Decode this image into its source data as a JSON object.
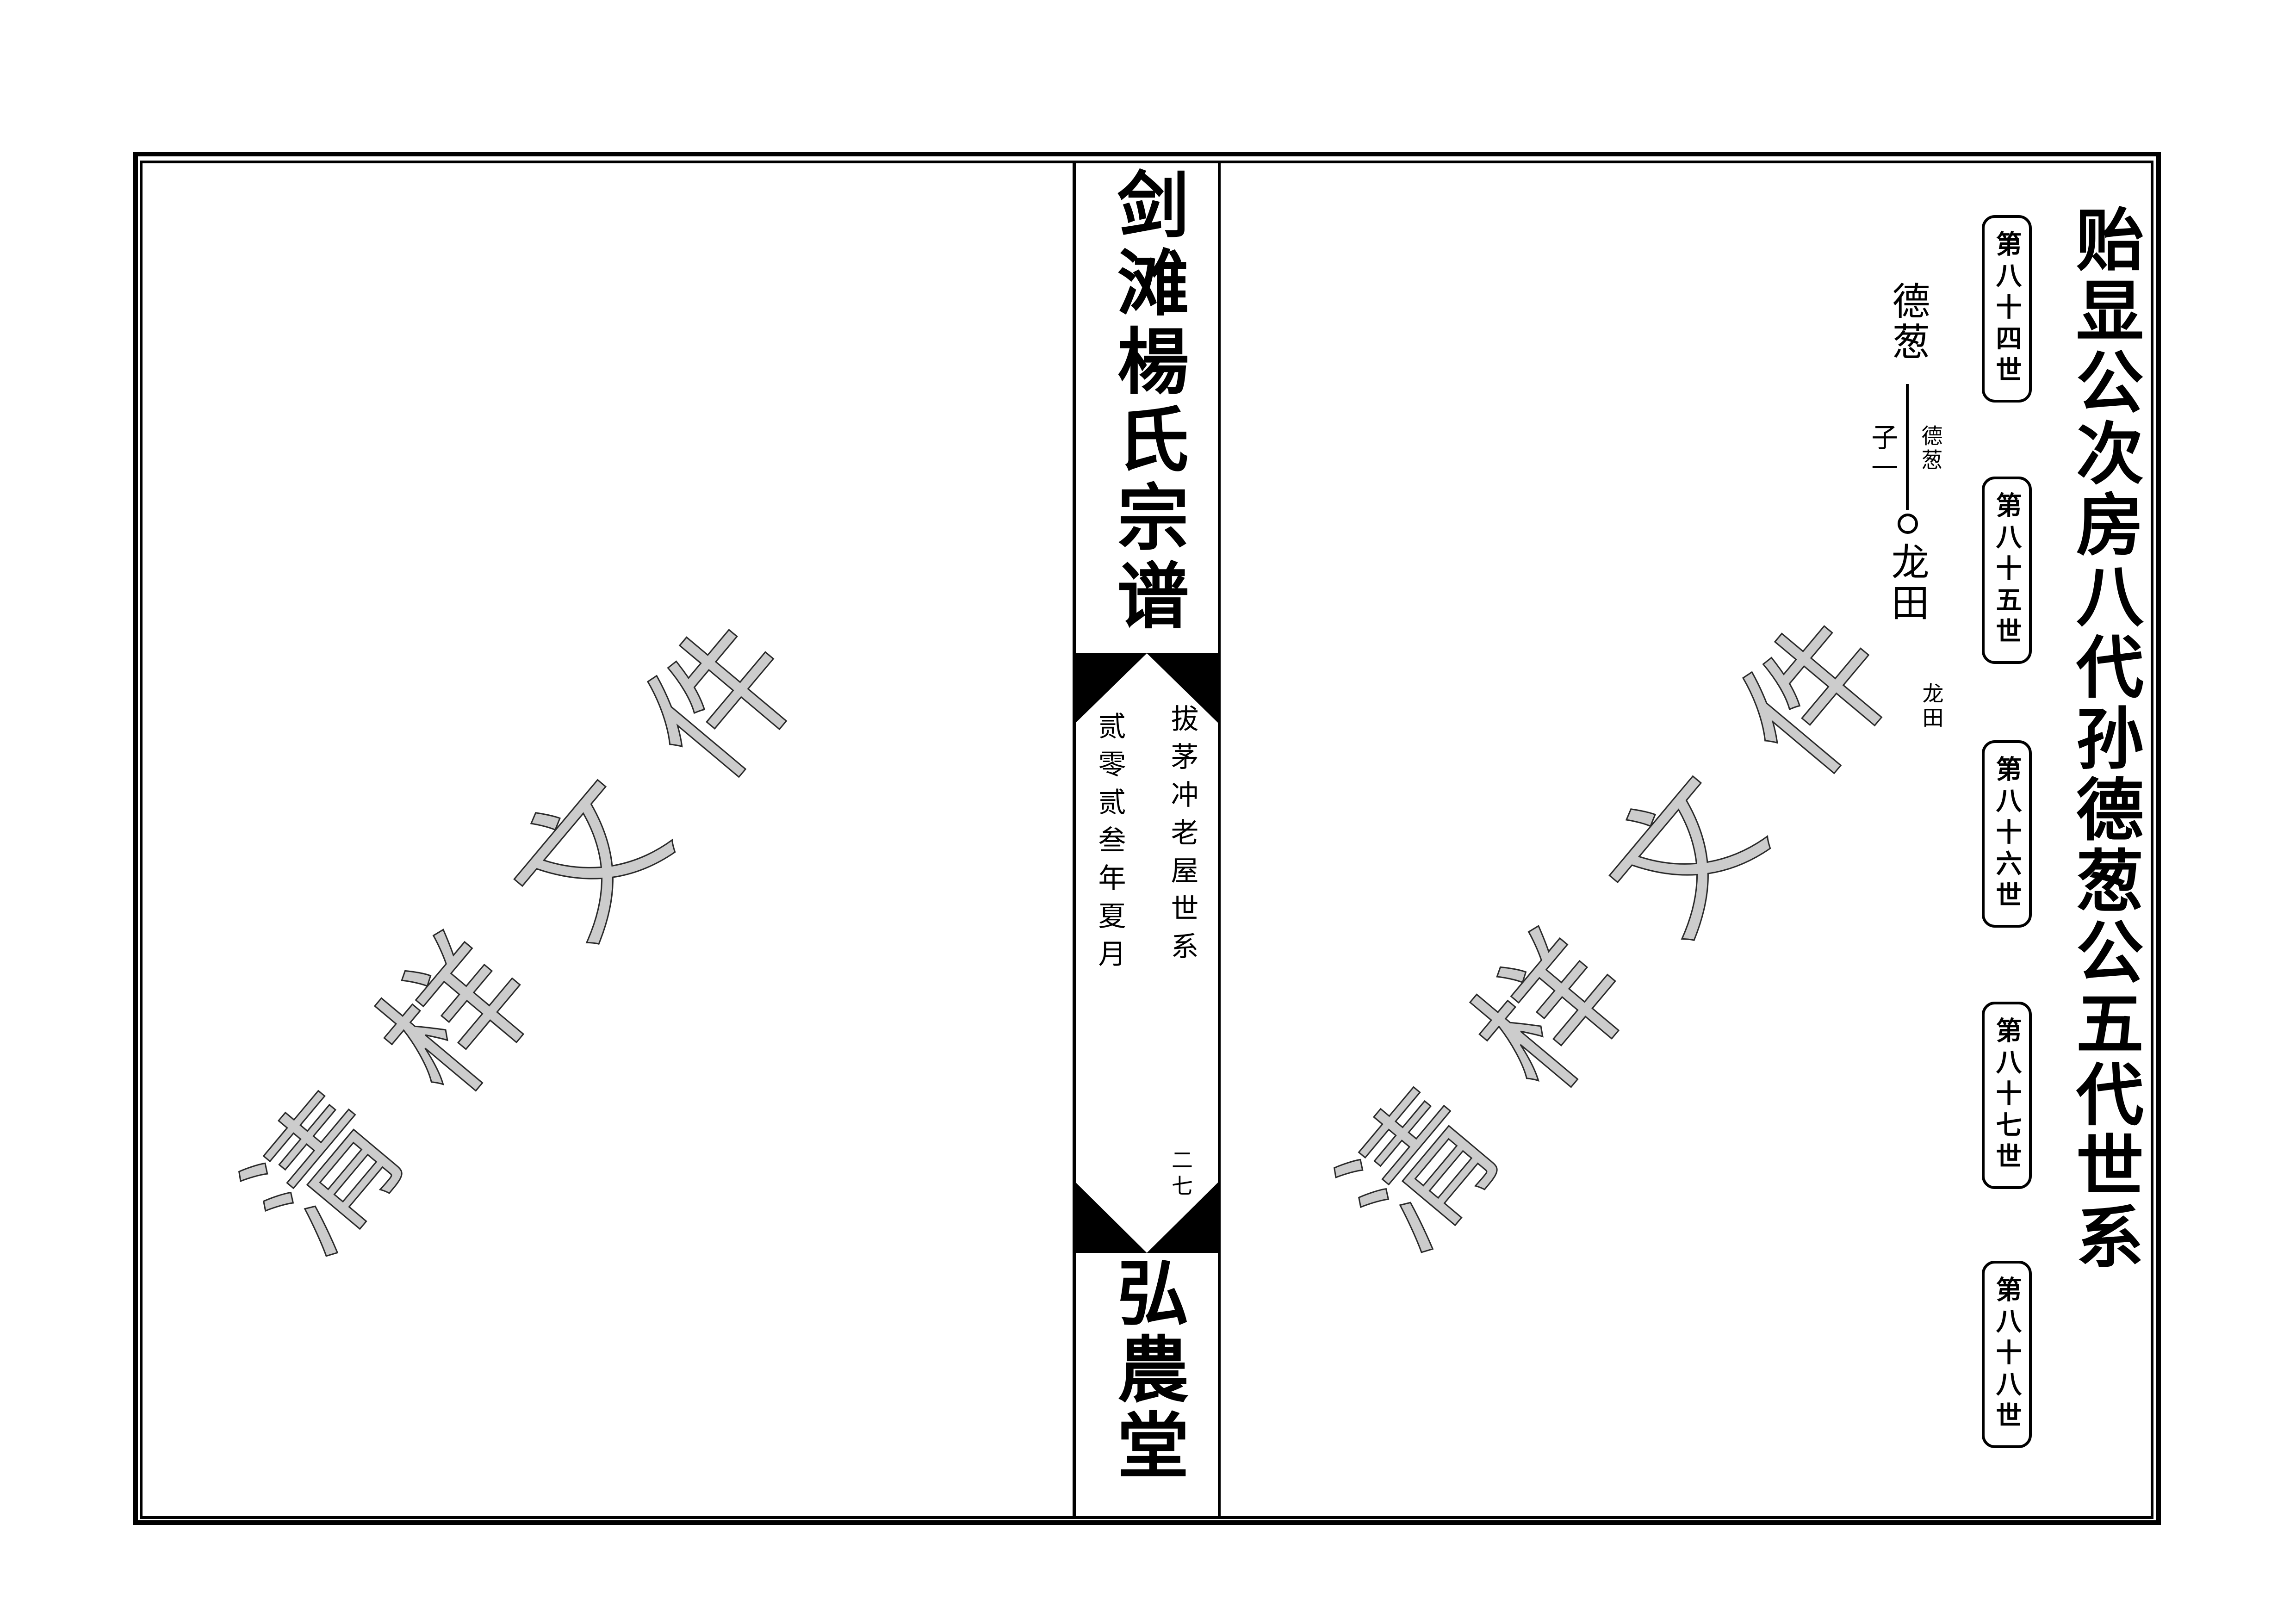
{
  "page": {
    "watermark_text": "清样文件",
    "watermark_fill_color": "#cccccc",
    "watermark_outline_color": "#2a2a2a",
    "ink_color": "#000000",
    "background_color": "#ffffff"
  },
  "spine": {
    "title": "剑滩楊氏宗谱",
    "section_note": "拔茅冲老屋世系",
    "date_note": "贰零贰叁年夏月",
    "page_number": "二七",
    "hall_name": "弘農堂"
  },
  "right_page": {
    "title": "贻显公次房八代孙德葱公五代世系",
    "generation_labels": [
      "第八十四世",
      "第八十五世",
      "第八十六世",
      "第八十七世",
      "第八十八世"
    ],
    "tree": {
      "ancestor_name": "德葱",
      "ancestor_note": "德葱",
      "children_label": "子一",
      "descendant_name": "龙田",
      "descendant_note": "龙田"
    }
  }
}
